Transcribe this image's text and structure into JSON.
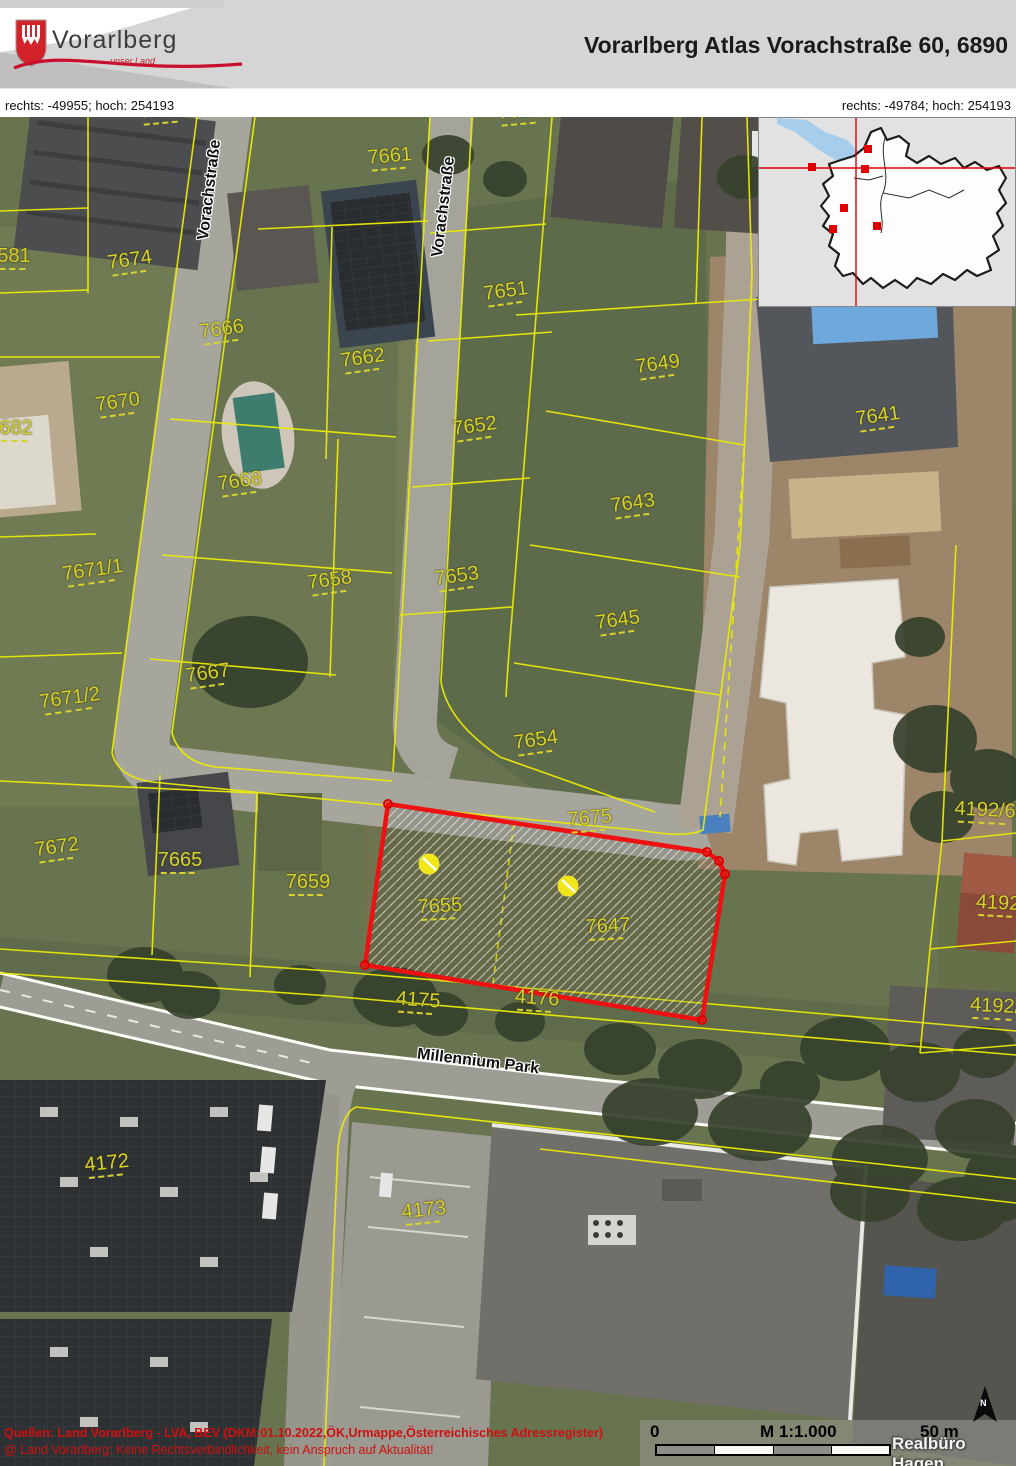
{
  "header": {
    "logo_text": "Vorarlberg",
    "logo_tagline": "unser Land",
    "title": "Vorarlberg Atlas Vorachstraße 60, 6890"
  },
  "coordinates": {
    "left": "rechts: -49955; hoch: 254193",
    "right": "rechts: -49784; hoch: 254193"
  },
  "map": {
    "highlighted_parcels": [
      "7655",
      "7647"
    ],
    "colors": {
      "parcel_line": "#ebeb06",
      "parcel_label": "#d8d22e",
      "highlight_border": "#ee1111",
      "address_point": "#f0e61a",
      "source_text": "#cf1010"
    },
    "street_labels": [
      {
        "text": "Vorachstraße",
        "x": 210,
        "y": 73,
        "rot": -83
      },
      {
        "text": "Vorachstraße",
        "x": 444,
        "y": 90,
        "rot": -83
      },
      {
        "text": "Millennium Park",
        "x": 478,
        "y": 945,
        "rot": 7
      }
    ],
    "parcel_labels": [
      {
        "text": "7673",
        "x": 162,
        "y": -5,
        "rot": -5
      },
      {
        "text": "7657",
        "x": 520,
        "y": -4,
        "rot": -5
      },
      {
        "text": "7661",
        "x": 390,
        "y": 41,
        "rot": -5
      },
      {
        "text": "7674",
        "x": 130,
        "y": 145,
        "rot": -8
      },
      {
        "text": "581",
        "x": 14,
        "y": 141,
        "rot": 0
      },
      {
        "text": "7666",
        "x": 222,
        "y": 214,
        "rot": -8
      },
      {
        "text": "7662",
        "x": 363,
        "y": 243,
        "rot": -8
      },
      {
        "text": "7651",
        "x": 506,
        "y": 176,
        "rot": -8
      },
      {
        "text": "7670",
        "x": 118,
        "y": 287,
        "rot": -8
      },
      {
        "text": "682",
        "x": 16,
        "y": 313,
        "rot": 0
      },
      {
        "text": "7652",
        "x": 475,
        "y": 311,
        "rot": -8
      },
      {
        "text": "7668",
        "x": 240,
        "y": 366,
        "rot": -8
      },
      {
        "text": "7649",
        "x": 658,
        "y": 249,
        "rot": -8
      },
      {
        "text": "7643",
        "x": 633,
        "y": 388,
        "rot": -8
      },
      {
        "text": "7653",
        "x": 457,
        "y": 461,
        "rot": -8
      },
      {
        "text": "7658",
        "x": 330,
        "y": 465,
        "rot": -8
      },
      {
        "text": "7671/1",
        "x": 93,
        "y": 455,
        "rot": -8
      },
      {
        "text": "7645",
        "x": 618,
        "y": 505,
        "rot": -8
      },
      {
        "text": "7667",
        "x": 208,
        "y": 558,
        "rot": -8
      },
      {
        "text": "7671/2",
        "x": 70,
        "y": 583,
        "rot": -8
      },
      {
        "text": "7641",
        "x": 878,
        "y": 301,
        "rot": -8
      },
      {
        "text": "7654",
        "x": 536,
        "y": 625,
        "rot": -8
      },
      {
        "text": "7675",
        "x": 590,
        "y": 703,
        "rot": -5
      },
      {
        "text": "7672",
        "x": 57,
        "y": 732,
        "rot": -8
      },
      {
        "text": "7665",
        "x": 180,
        "y": 745,
        "rot": 0
      },
      {
        "text": "7659",
        "x": 308,
        "y": 767,
        "rot": 0
      },
      {
        "text": "7655",
        "x": 440,
        "y": 791,
        "rot": -3
      },
      {
        "text": "7647",
        "x": 608,
        "y": 811,
        "rot": -3
      },
      {
        "text": "4175",
        "x": 418,
        "y": 885,
        "rot": 4
      },
      {
        "text": "4176",
        "x": 537,
        "y": 883,
        "rot": 4
      },
      {
        "text": "4192/6",
        "x": 985,
        "y": 695,
        "rot": 3
      },
      {
        "text": "4192",
        "x": 998,
        "y": 788,
        "rot": 3
      },
      {
        "text": "4192/",
        "x": 995,
        "y": 891,
        "rot": 3
      },
      {
        "text": "4172",
        "x": 107,
        "y": 1048,
        "rot": -6
      },
      {
        "text": "4173",
        "x": 424,
        "y": 1095,
        "rot": -6
      }
    ]
  },
  "footer": {
    "source_line1": "Quellen: Land Vorarlberg - LVA, BEV (DKM:01.10.2022,ÖK,Urmappe,Österreichisches Adressregister)",
    "source_line2": "@ Land Vorarlberg: Keine Rechtsverbindlichkeit, kein Anspruch auf Aktualität!",
    "scale": {
      "zero": "0",
      "ratio": "M 1:1.000",
      "distance": "50 m"
    },
    "watermark": "Realbüro Hagen",
    "north": "N"
  }
}
